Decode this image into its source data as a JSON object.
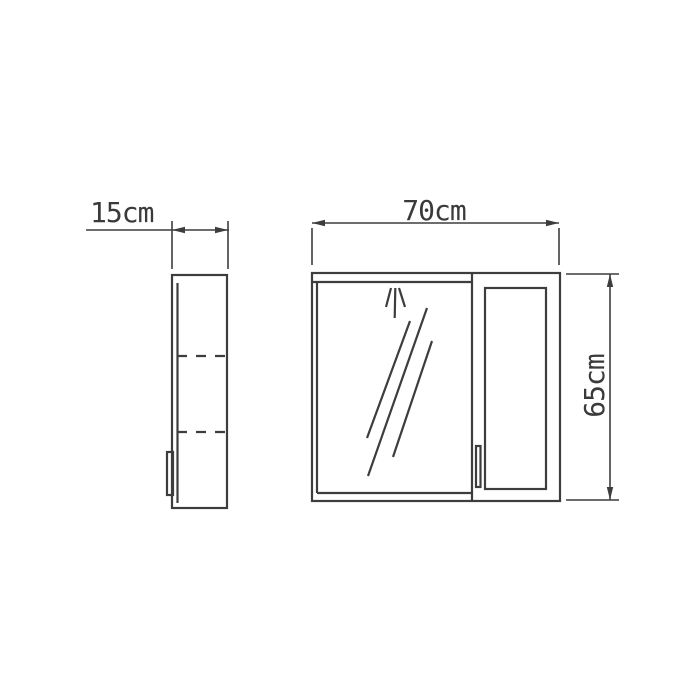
{
  "drawing": {
    "type": "technical-dimension-drawing",
    "views": {
      "side": {
        "depth_label": "15cm",
        "depth_cm": 15
      },
      "front": {
        "width_label": "70cm",
        "width_cm": 70,
        "height_label": "65cm",
        "height_cm": 65
      }
    },
    "colors": {
      "background": "#ffffff",
      "line": "#3d3d3d",
      "text": "#3a3a3a"
    }
  }
}
